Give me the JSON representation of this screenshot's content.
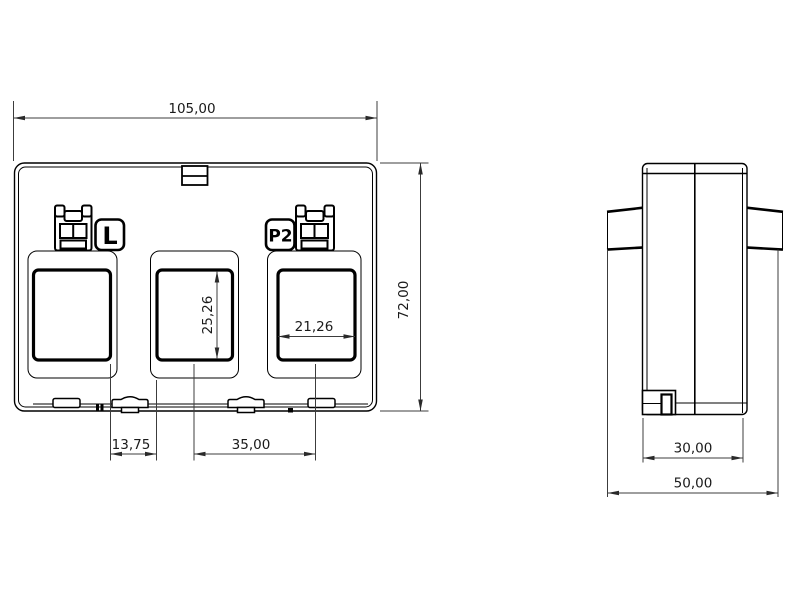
{
  "page": {
    "background_color": "#ffffff",
    "line_color": "#000000"
  },
  "front_view": {
    "terminal_labels": {
      "left": "L",
      "right": "P2"
    },
    "dimensions": {
      "overall_width": "105,00",
      "overall_height": "72,00",
      "window_height": "25,26",
      "window_width": "21,26",
      "window_edge_gap": "13,75",
      "window_spacing": "35,00"
    }
  },
  "side_view": {
    "dimensions": {
      "body_width": "30,00",
      "overall_depth": "50,00"
    }
  }
}
